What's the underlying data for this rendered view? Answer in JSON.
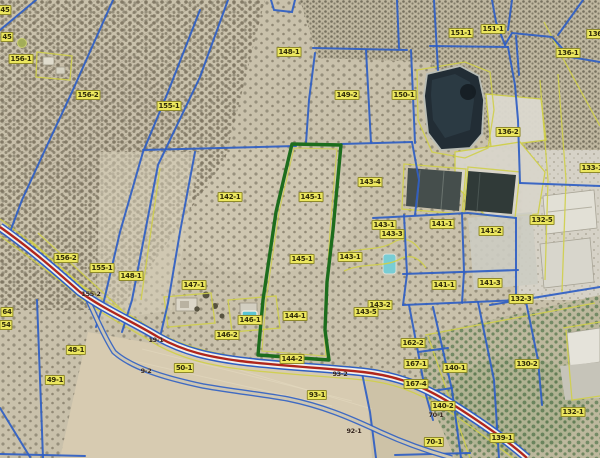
{
  "app": {
    "title": "Aerial orthophoto cadastral parcel viewer",
    "view": "orthophoto with cadastral parcel overlay"
  },
  "map": {
    "highlighted_parcel": "145-1",
    "colors": {
      "parcel_line": "#2f5fc4",
      "enclosure_line": "#cfcf4a",
      "highlight_outline": "#1d6d1d",
      "road_center": "#b0261c",
      "road_fill": "#f2f1ec",
      "label_bg": "#ece75f",
      "label_border": "#8f8a2a",
      "label_text": "#2e2a08",
      "road_label_text": "#33231a"
    },
    "features": [
      {
        "name": "olive-grove"
      },
      {
        "name": "irrigation-pond"
      },
      {
        "name": "greenhouse-building"
      },
      {
        "name": "warehouse-building"
      },
      {
        "name": "swimming-pool"
      },
      {
        "name": "farm-building"
      },
      {
        "name": "plowed-field"
      },
      {
        "name": "main-road"
      },
      {
        "name": "farm-track"
      }
    ],
    "parcel_labels": [
      {
        "t": "45",
        "x": 5,
        "y": 10
      },
      {
        "t": "45",
        "x": 7,
        "y": 37
      },
      {
        "t": "156-1",
        "x": 21,
        "y": 59
      },
      {
        "t": "156-2",
        "x": 88,
        "y": 95
      },
      {
        "t": "155-1",
        "x": 169,
        "y": 106
      },
      {
        "t": "148-1",
        "x": 289,
        "y": 52
      },
      {
        "t": "149-2",
        "x": 347,
        "y": 95
      },
      {
        "t": "150-1",
        "x": 404,
        "y": 95
      },
      {
        "t": "151-1",
        "x": 461,
        "y": 33
      },
      {
        "t": "151-1",
        "x": 493,
        "y": 29
      },
      {
        "t": "136",
        "x": 595,
        "y": 34
      },
      {
        "t": "136-1",
        "x": 568,
        "y": 53
      },
      {
        "t": "136-2",
        "x": 508,
        "y": 132
      },
      {
        "t": "133-1",
        "x": 592,
        "y": 168
      },
      {
        "t": "142-1",
        "x": 230,
        "y": 197
      },
      {
        "t": "145-1",
        "x": 311,
        "y": 197
      },
      {
        "t": "143-4",
        "x": 370,
        "y": 182
      },
      {
        "t": "143-1",
        "x": 384,
        "y": 225
      },
      {
        "t": "143-3",
        "x": 392,
        "y": 234
      },
      {
        "t": "141-1",
        "x": 442,
        "y": 224
      },
      {
        "t": "141-2",
        "x": 491,
        "y": 231
      },
      {
        "t": "132-5",
        "x": 542,
        "y": 220
      },
      {
        "t": "156-2",
        "x": 66,
        "y": 258
      },
      {
        "t": "155-1",
        "x": 102,
        "y": 268
      },
      {
        "t": "148-1",
        "x": 131,
        "y": 276
      },
      {
        "t": "147-1",
        "x": 194,
        "y": 285
      },
      {
        "t": "145-1",
        "x": 302,
        "y": 259
      },
      {
        "t": "143-1",
        "x": 350,
        "y": 257
      },
      {
        "t": "141-1",
        "x": 444,
        "y": 285
      },
      {
        "t": "141-3",
        "x": 490,
        "y": 283
      },
      {
        "t": "132-3",
        "x": 521,
        "y": 299
      },
      {
        "t": "146-1",
        "x": 250,
        "y": 320
      },
      {
        "t": "144-1",
        "x": 295,
        "y": 316
      },
      {
        "t": "146-2",
        "x": 227,
        "y": 335
      },
      {
        "t": "144-2",
        "x": 292,
        "y": 359
      },
      {
        "t": "143-2",
        "x": 380,
        "y": 305
      },
      {
        "t": "143-5",
        "x": 366,
        "y": 312
      },
      {
        "t": "162-2",
        "x": 413,
        "y": 343
      },
      {
        "t": "167-1",
        "x": 416,
        "y": 364
      },
      {
        "t": "167-4",
        "x": 416,
        "y": 384
      },
      {
        "t": "140-1",
        "x": 455,
        "y": 368
      },
      {
        "t": "130-2",
        "x": 527,
        "y": 364
      },
      {
        "t": "132-1",
        "x": 573,
        "y": 412
      },
      {
        "t": "140-2",
        "x": 443,
        "y": 406
      },
      {
        "t": "70-1",
        "x": 434,
        "y": 442
      },
      {
        "t": "139-1",
        "x": 502,
        "y": 438
      },
      {
        "t": "93-1",
        "x": 317,
        "y": 395
      },
      {
        "t": "50-1",
        "x": 184,
        "y": 368
      },
      {
        "t": "48-1",
        "x": 76,
        "y": 350
      },
      {
        "t": "49-1",
        "x": 55,
        "y": 380
      },
      {
        "t": "64",
        "x": 7,
        "y": 312
      },
      {
        "t": "54",
        "x": 6,
        "y": 325
      }
    ],
    "road_labels": [
      {
        "t": "155-2",
        "x": 91,
        "y": 294
      },
      {
        "t": "19-1",
        "x": 156,
        "y": 340
      },
      {
        "t": "9-2",
        "x": 146,
        "y": 371
      },
      {
        "t": "93-2",
        "x": 340,
        "y": 374
      },
      {
        "t": "92-1",
        "x": 354,
        "y": 431
      },
      {
        "t": "70-1",
        "x": 436,
        "y": 415
      }
    ]
  }
}
